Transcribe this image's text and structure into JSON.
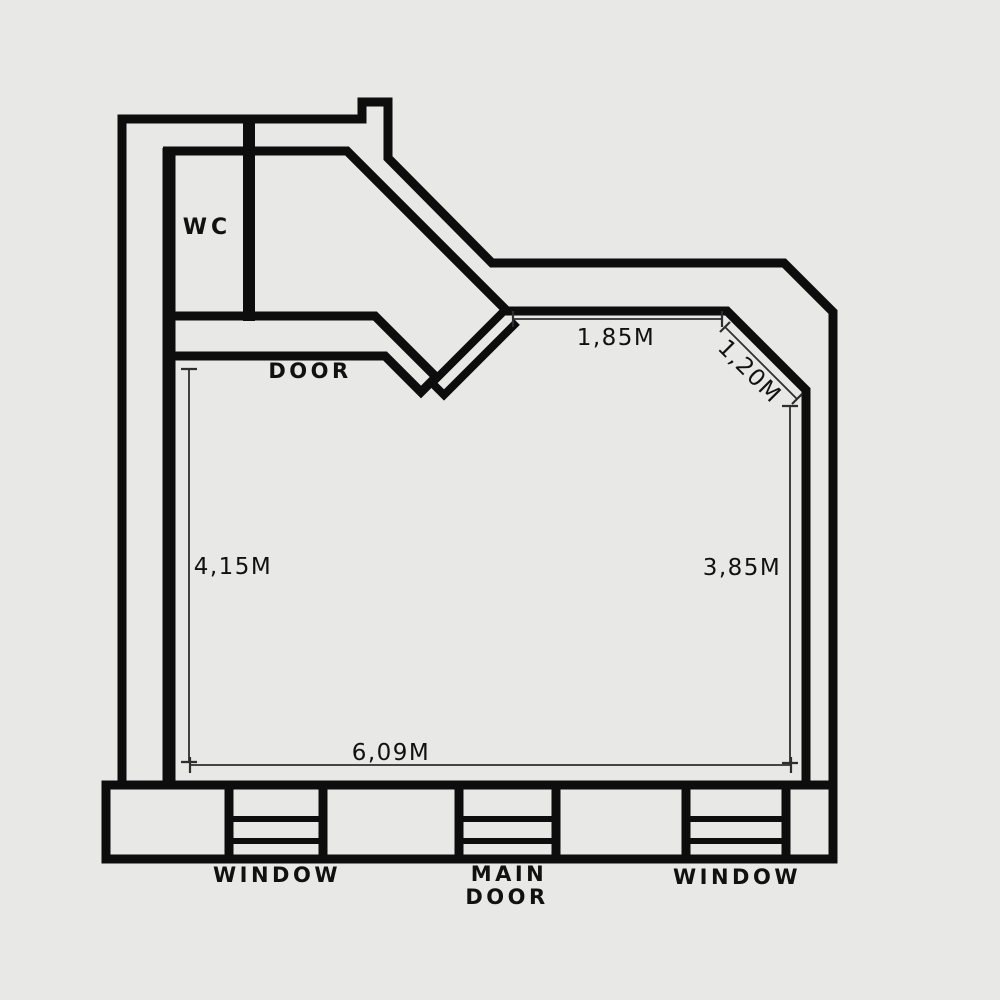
{
  "drawing": {
    "type": "architectural floor plan",
    "colors": {
      "background": "#e8e8e6",
      "wall": "#0d0d0d",
      "dimension_line": "#2e2e2e",
      "text": "#111111"
    },
    "rooms": {
      "wc_label": "WC"
    },
    "openings": {
      "door_label": "DOOR",
      "main_door_line1": "MAIN",
      "main_door_line2": "DOOR",
      "window_left_label": "WINDOW",
      "window_right_label": "WINDOW"
    },
    "dimensions": {
      "top_wall": "1,85M",
      "diagonal_wall": "1,20M",
      "left_wall": "4,15M",
      "right_wall": "3,85M",
      "bottom_wall": "6,09M"
    }
  }
}
